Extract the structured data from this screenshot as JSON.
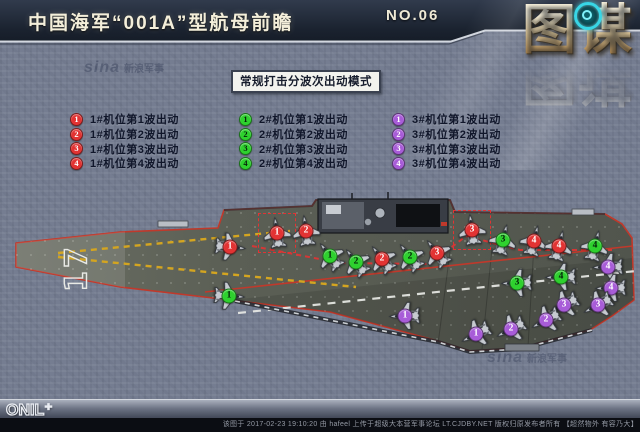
{
  "header": {
    "title": "中国海军“001A”型航母前瞻",
    "issue": "NO.06"
  },
  "brand": {
    "logo": "图谋",
    "reticle_icon": "target-reticle"
  },
  "watermarks": {
    "sina_script": "sina",
    "sina_cn": "新浪军事"
  },
  "legend": {
    "title": "常规打击分波次出动模式",
    "groups": [
      {
        "position": "1#",
        "badge_color": "#e23333",
        "num_color": "#ffffff",
        "items": [
          {
            "n": "1",
            "label": "1#机位第1波出动"
          },
          {
            "n": "2",
            "label": "1#机位第2波出动"
          },
          {
            "n": "3",
            "label": "1#机位第3波出动"
          },
          {
            "n": "4",
            "label": "1#机位第4波出动"
          }
        ]
      },
      {
        "position": "2#",
        "badge_color": "#2ed12e",
        "num_color": "#06230a",
        "items": [
          {
            "n": "1",
            "label": "2#机位第1波出动"
          },
          {
            "n": "2",
            "label": "2#机位第2波出动"
          },
          {
            "n": "3",
            "label": "2#机位第3波出动"
          },
          {
            "n": "4",
            "label": "2#机位第4波出动"
          }
        ]
      },
      {
        "position": "3#",
        "badge_color": "#a85cd8",
        "num_color": "#ffffff",
        "items": [
          {
            "n": "1",
            "label": "3#机位第1波出动"
          },
          {
            "n": "2",
            "label": "3#机位第2波出动"
          },
          {
            "n": "3",
            "label": "3#机位第3波出动"
          },
          {
            "n": "4",
            "label": "3#机位第4波出动"
          }
        ]
      }
    ]
  },
  "deck": {
    "hull_number": "17",
    "markers": [
      {
        "color": "red",
        "n": "1",
        "x": 230,
        "y": 247,
        "rot": 96
      },
      {
        "color": "red",
        "n": "1",
        "x": 277,
        "y": 233,
        "rot": -8,
        "boxed": true
      },
      {
        "color": "red",
        "n": "2",
        "x": 306,
        "y": 231,
        "rot": -8
      },
      {
        "color": "green",
        "n": "1",
        "x": 330,
        "y": 256,
        "rot": -38
      },
      {
        "color": "green",
        "n": "2",
        "x": 356,
        "y": 262,
        "rot": -38
      },
      {
        "color": "red",
        "n": "2",
        "x": 382,
        "y": 259,
        "rot": -38
      },
      {
        "color": "green",
        "n": "2",
        "x": 410,
        "y": 257,
        "rot": -38
      },
      {
        "color": "red",
        "n": "3",
        "x": 437,
        "y": 253,
        "rot": -38
      },
      {
        "color": "red",
        "n": "3",
        "x": 472,
        "y": 230,
        "rot": -8,
        "boxed": true
      },
      {
        "color": "green",
        "n": "3",
        "x": 503,
        "y": 240,
        "rot": 14
      },
      {
        "color": "red",
        "n": "4",
        "x": 534,
        "y": 241,
        "rot": 14
      },
      {
        "color": "red",
        "n": "4",
        "x": 559,
        "y": 246,
        "rot": 14
      },
      {
        "color": "green",
        "n": "4",
        "x": 595,
        "y": 246,
        "rot": 14
      },
      {
        "color": "green",
        "n": "1",
        "x": 229,
        "y": 296,
        "rot": 94
      },
      {
        "color": "green",
        "n": "3",
        "x": 517,
        "y": 283,
        "rot": -92
      },
      {
        "color": "green",
        "n": "4",
        "x": 561,
        "y": 277,
        "rot": -92
      },
      {
        "color": "purple",
        "n": "4",
        "x": 608,
        "y": 267,
        "rot": -92
      },
      {
        "color": "purple",
        "n": "4",
        "x": 611,
        "y": 288,
        "rot": -92
      },
      {
        "color": "purple",
        "n": "3",
        "x": 564,
        "y": 305,
        "rot": -118
      },
      {
        "color": "purple",
        "n": "3",
        "x": 598,
        "y": 305,
        "rot": -118
      },
      {
        "color": "purple",
        "n": "2",
        "x": 546,
        "y": 320,
        "rot": -118
      },
      {
        "color": "purple",
        "n": "2",
        "x": 511,
        "y": 329,
        "rot": -118
      },
      {
        "color": "purple",
        "n": "1",
        "x": 476,
        "y": 334,
        "rot": -118
      },
      {
        "color": "purple",
        "n": "1",
        "x": 405,
        "y": 316,
        "rot": -92
      }
    ]
  },
  "footer": {
    "logo": "ONIL⁺",
    "caption": "该图于 2017-02-23 19:10:20 由 hafeel 上传于超级大本营军事论坛 LT.CJDBY.NET 版权归原发布者所有 【超然物外 有容乃大】"
  },
  "colors": {
    "red": "#e23333",
    "green": "#2ed12e",
    "purple": "#a85cd8",
    "deck": "#585c54",
    "deck_edge": "#c0392b",
    "accent_line": "#d8dce4"
  }
}
